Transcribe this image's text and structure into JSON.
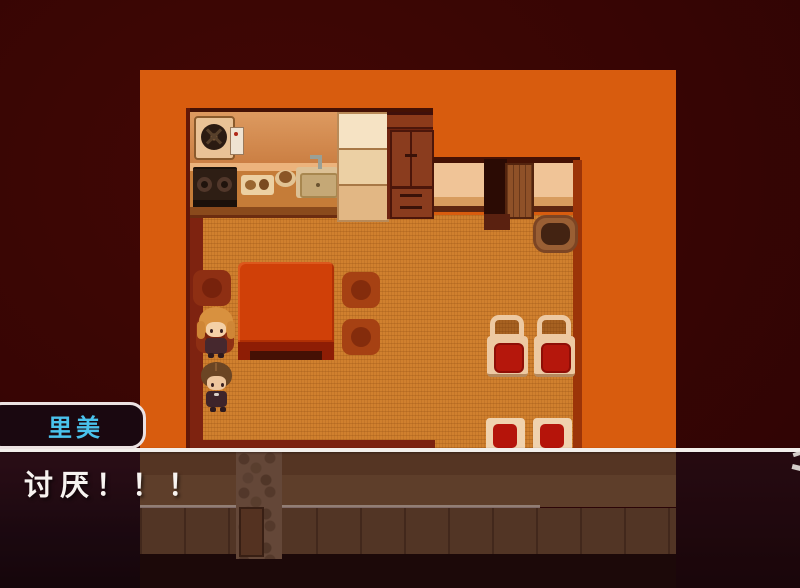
{
  "game": {
    "type": "rpg-maker-style-scene",
    "location_description": "kitchen-dining-room-interior"
  },
  "message_window": {
    "name_tag": {
      "label": "里美",
      "text_color": "#4ac2ec"
    },
    "dialogue": {
      "text": "讨厌！！！",
      "text_color": "#f7f3f0"
    }
  },
  "characters": [
    {
      "name": "girl-orange-hair",
      "hair_color": "#d8913f"
    },
    {
      "name": "girl-brown-hair",
      "hair_color": "#6b4524"
    }
  ],
  "map_objects": [
    "exhaust-fan",
    "water-heater",
    "gas-stove",
    "cutting-board",
    "food-dish",
    "kitchen-sink",
    "faucet",
    "refrigerator",
    "wooden-cabinet",
    "kitchen-counter",
    "side-counter-left",
    "side-counter-right",
    "doorway",
    "wooden-door",
    "entry-mat",
    "dining-table",
    "floor-cushion-1",
    "floor-cushion-2",
    "floor-cushion-3",
    "floor-cushion-4",
    "chair-with-back-1",
    "chair-with-back-2",
    "chair-seat-1",
    "chair-seat-2",
    "basket-pot",
    "stone-path",
    "wooden-crate"
  ],
  "palette": {
    "background_maroon": "#370504",
    "backdrop_orange": "#d85c0e",
    "tatami_floor": "#d0802e",
    "table_red": "#d04008",
    "dark_wood": "#6f2410",
    "light_counter": "#eed3a8",
    "cushion_red": "#b5170c",
    "window_border": "#ece2e2",
    "window_fill": "rgba(24,9,17,0.94)",
    "dialogue_line": "#f3efeb"
  }
}
